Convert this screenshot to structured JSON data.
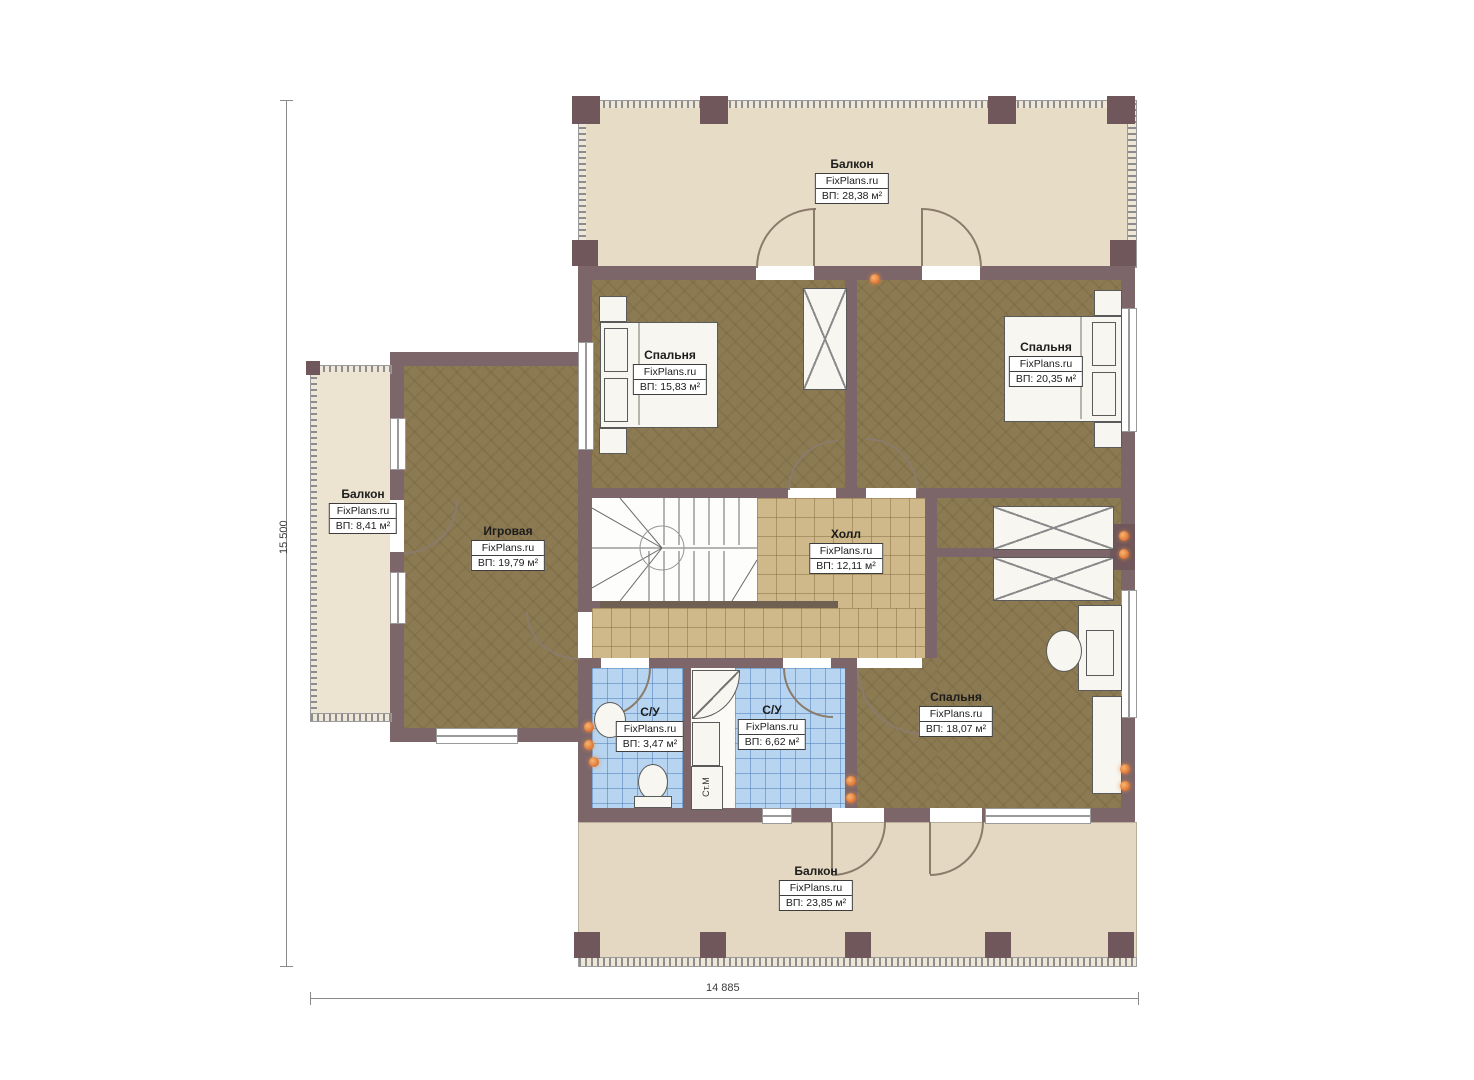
{
  "plan": {
    "rooms": [
      {
        "id": "balcony-top",
        "name": "Балкон",
        "brand": "FixPlans.ru",
        "area": "ВП: 28,38 м²"
      },
      {
        "id": "bedroom-1",
        "name": "Спальня",
        "brand": "FixPlans.ru",
        "area": "ВП: 15,83 м²"
      },
      {
        "id": "bedroom-2",
        "name": "Спальня",
        "brand": "FixPlans.ru",
        "area": "ВП: 20,35 м²"
      },
      {
        "id": "balcony-left",
        "name": "Балкон",
        "brand": "FixPlans.ru",
        "area": "ВП: 8,41 м²"
      },
      {
        "id": "playroom",
        "name": "Игровая",
        "brand": "FixPlans.ru",
        "area": "ВП: 19,79 м²"
      },
      {
        "id": "hall",
        "name": "Холл",
        "brand": "FixPlans.ru",
        "area": "ВП: 12,11 м²"
      },
      {
        "id": "wc-1",
        "name": "С/У",
        "brand": "FixPlans.ru",
        "area": "ВП: 3,47 м²"
      },
      {
        "id": "wc-2",
        "name": "С/У",
        "brand": "FixPlans.ru",
        "area": "ВП: 6,62 м²"
      },
      {
        "id": "bedroom-3",
        "name": "Спальня",
        "brand": "FixPlans.ru",
        "area": "ВП: 18,07 м²"
      },
      {
        "id": "balcony-bottom",
        "name": "Балкон",
        "brand": "FixPlans.ru",
        "area": "ВП: 23,85 м²"
      }
    ],
    "dimensions": {
      "height_label": "15 500",
      "width_label": "14 885"
    },
    "appliances": {
      "washer": "Ст.М"
    },
    "colors": {
      "wall": "#7c666a",
      "floor_dark": "#8c7a52",
      "hall_tile": "#cfb98b",
      "bath_tile": "#b7d4f0",
      "balcony": "#e7ddc7",
      "lamp": "#dd7030"
    }
  }
}
